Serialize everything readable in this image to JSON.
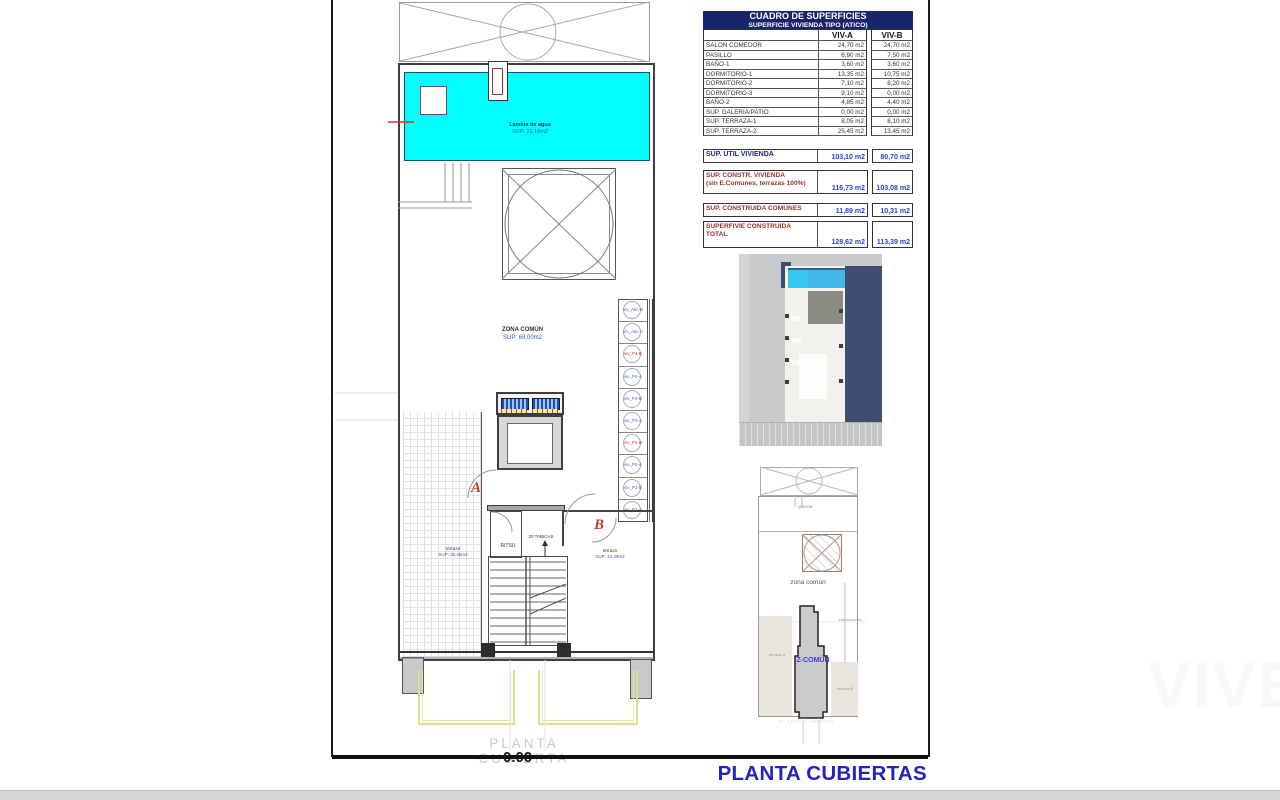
{
  "page": {
    "title_main": "PLANTA CUBIERTAS",
    "watermark_floor": "PLANTA CUBIERTA",
    "elevation_clipped": "0.00",
    "brand_watermark": "VIVE"
  },
  "table": {
    "title": "CUADRO DE SUPERFICIES",
    "subtitle": "SUPERFICIE VIVIENDA TIPO  (ATICO)",
    "col_a": "VIV-A",
    "col_b": "VIV-B",
    "rows": [
      {
        "label": "SALON COMEDOR",
        "a": "24,70 m2",
        "b": "24,70 m2"
      },
      {
        "label": "PASILLO",
        "a": "6,90 m2",
        "b": "7,50 m2"
      },
      {
        "label": "BAÑO-1",
        "a": "3,60 m2",
        "b": "3,60 m2"
      },
      {
        "label": "DORMITORIO-1",
        "a": "13,35 m2",
        "b": "10,75 m2"
      },
      {
        "label": "DORMITORIO-2",
        "a": "7,10 m2",
        "b": "8,20 m2"
      },
      {
        "label": "DORMITORIO-3",
        "a": "9,10 m2",
        "b": "0,00 m2"
      },
      {
        "label": "BAÑO-2",
        "a": "4,85 m2",
        "b": "4,40 m2"
      },
      {
        "label": "SUP. GALERIA/PATIO",
        "a": "0,00 m2",
        "b": "0,00 m2"
      },
      {
        "label": "SUP. TERRAZA-1",
        "a": "8,05 m2",
        "b": "8,10 m2"
      },
      {
        "label": "SUP. TERRAZA-2",
        "a": "25,45 m2",
        "b": "13,45 m2"
      }
    ],
    "summary": [
      {
        "label": "SUP. UTIL VIVIENDA",
        "label2": "",
        "a": "103,10 m2",
        "b": "80,70 m2"
      },
      {
        "label": "SUP. CONSTR. VIVIENDA",
        "label2": "(sin E.Comunes, terrazas 100%)",
        "a": "116,73 m2",
        "b": "103,08 m2"
      },
      {
        "label": "SUP. CONSTRUIDA COMUNES",
        "label2": "",
        "a": "11,89 m2",
        "b": "10,31 m2"
      },
      {
        "label": "SUPERFIVIE CONSTRUIDA",
        "label2": "TOTAL",
        "a": "128,62 m2",
        "b": "113,39 m2"
      }
    ]
  },
  "plan": {
    "pool_label": "Lamina de agua",
    "pool_area": "SUP: 21,16m2",
    "common_label": "ZONA COMÚN",
    "common_area": "SUP: 69,00m2",
    "terrace_left_label": "terraza",
    "terrace_left_area": "SUP: 25,45m2",
    "terrace_right_label": "terraza",
    "terrace_right_area": "SUP: 13,45m2",
    "room_label": "RITSU",
    "stairs_note": "20 TABICAS",
    "door_a": "A",
    "door_b": "B",
    "column_marker": "+",
    "vents": [
      "viv_Atic-B",
      "viv_Atic-A",
      "viv_P4-B",
      "viv_P4-A",
      "viv_P3-B",
      "viv_P3-A",
      "viv_P2-B",
      "viv_P2-A",
      "viv_P1-B",
      "viv_P1-A"
    ]
  },
  "diagram": {
    "pool_label": "piscina",
    "common_label": "zona común",
    "z_common": "Z-COMÚN",
    "terrace_a": "terraza-A",
    "terrace_b": "terraza-B",
    "installations": "instalaciones",
    "caption": "PLANTA CUBIERTA"
  },
  "colors": {
    "pool_cyan": "#00FFFF",
    "header_bg": "#18246B",
    "value_blue": "#2A3FD4",
    "label_maroon": "#92332A",
    "navy": "#1B2B80",
    "accent_red": "#C03A34",
    "title_blue": "#2323BD",
    "shadow_blue": "#3D4E70",
    "render_pool": "#41B6E8"
  }
}
